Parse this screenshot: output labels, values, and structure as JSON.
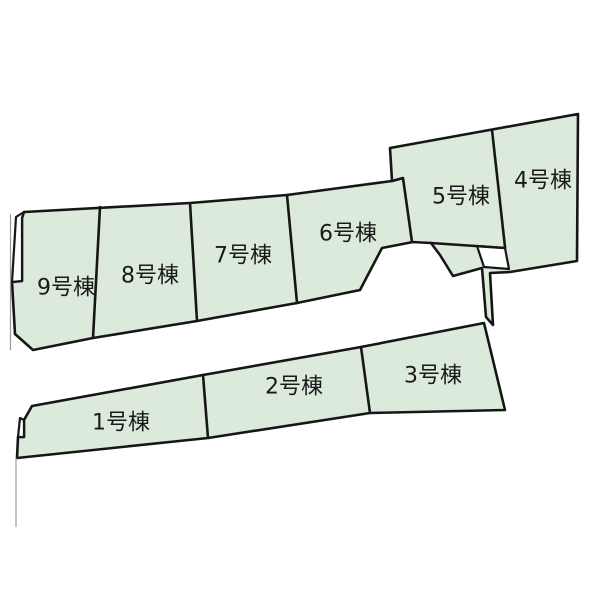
{
  "diagram": {
    "width": 600,
    "height": 599,
    "background_color": "#ffffff",
    "lot_fill_color": "#dbeadb",
    "outline_color": "#161616",
    "label_color": "#1a1a1a",
    "label_font_size": 22,
    "faint_line_color": "#9b9b9b",
    "lots": [
      {
        "id": "1",
        "label": "1号棟",
        "label_x": 121,
        "label_y": 423
      },
      {
        "id": "2",
        "label": "2号棟",
        "label_x": 294,
        "label_y": 387
      },
      {
        "id": "3",
        "label": "3号棟",
        "label_x": 433,
        "label_y": 376
      },
      {
        "id": "4",
        "label": "4号棟",
        "label_x": 543,
        "label_y": 181
      },
      {
        "id": "5",
        "label": "5号棟",
        "label_x": 461,
        "label_y": 197
      },
      {
        "id": "6",
        "label": "6号棟",
        "label_x": 348,
        "label_y": 234
      },
      {
        "id": "7",
        "label": "7号棟",
        "label_x": 243,
        "label_y": 256
      },
      {
        "id": "8",
        "label": "8号棟",
        "label_x": 150,
        "label_y": 276
      },
      {
        "id": "9",
        "label": "9号棟",
        "label_x": 66,
        "label_y": 288
      }
    ],
    "green_regions": [
      {
        "name": "upper-band",
        "points": [
          [
            24,
            212
          ],
          [
            190,
            203
          ],
          [
            287,
            195
          ],
          [
            392,
            181
          ],
          [
            403,
            178
          ],
          [
            413,
            242
          ],
          [
            382,
            248
          ],
          [
            360,
            290
          ],
          [
            297,
            303
          ],
          [
            197,
            321
          ],
          [
            93,
            338
          ],
          [
            33,
            350
          ],
          [
            15,
            334
          ],
          [
            12,
            282
          ],
          [
            22,
            281
          ],
          [
            22,
            218
          ]
        ]
      },
      {
        "name": "block-4-5",
        "points": [
          [
            390,
            148
          ],
          [
            578,
            114
          ],
          [
            577,
            261
          ],
          [
            510,
            272
          ],
          [
            490,
            273
          ],
          [
            493,
            325
          ],
          [
            486,
            317
          ],
          [
            482,
            268
          ],
          [
            453,
            276
          ],
          [
            440,
            255
          ],
          [
            431,
            243
          ],
          [
            412,
            242
          ],
          [
            403,
            178
          ],
          [
            392,
            181
          ]
        ]
      },
      {
        "name": "bottom-band",
        "points": [
          [
            32,
            406
          ],
          [
            203,
            375
          ],
          [
            361,
            347
          ],
          [
            484,
            323
          ],
          [
            505,
            410
          ],
          [
            370,
            413
          ],
          [
            208,
            438
          ],
          [
            17,
            458
          ],
          [
            18,
            437
          ],
          [
            24,
            437
          ],
          [
            24,
            420
          ]
        ]
      }
    ],
    "white_cutouts": [
      {
        "name": "left-notch-upper",
        "points": [
          [
            24,
            212
          ],
          [
            16,
            217
          ],
          [
            12,
            282
          ],
          [
            22,
            281
          ],
          [
            22,
            218
          ]
        ]
      },
      {
        "name": "left-notch-lower",
        "points": [
          [
            20,
            418
          ],
          [
            24,
            420
          ],
          [
            24,
            437
          ],
          [
            18,
            437
          ]
        ]
      },
      {
        "name": "center-pocket",
        "points": [
          [
            477,
            246
          ],
          [
            505,
            248
          ],
          [
            509,
            269
          ],
          [
            484,
            267
          ]
        ]
      }
    ],
    "separator_lines": [
      {
        "name": "sep-9-8",
        "x1": 100,
        "y1": 207,
        "x2": 93,
        "y2": 338
      },
      {
        "name": "sep-8-7",
        "x1": 190,
        "y1": 203,
        "x2": 197,
        "y2": 321
      },
      {
        "name": "sep-7-6",
        "x1": 287,
        "y1": 195,
        "x2": 297,
        "y2": 303
      },
      {
        "name": "sep-5-4",
        "x1": 492,
        "y1": 130,
        "x2": 505,
        "y2": 247
      },
      {
        "name": "sep-1-2",
        "x1": 203,
        "y1": 375,
        "x2": 208,
        "y2": 438
      },
      {
        "name": "sep-2-3",
        "x1": 361,
        "y1": 347,
        "x2": 370,
        "y2": 413
      },
      {
        "name": "line-5-bottom",
        "x1": 431,
        "y1": 243,
        "x2": 505,
        "y2": 248
      }
    ],
    "faint_lines": [
      {
        "name": "boundary-faint-upper",
        "x1": 10.5,
        "y1": 214,
        "x2": 10.5,
        "y2": 350
      },
      {
        "name": "boundary-faint-lower",
        "x1": 16,
        "y1": 458,
        "x2": 16,
        "y2": 527
      }
    ]
  }
}
